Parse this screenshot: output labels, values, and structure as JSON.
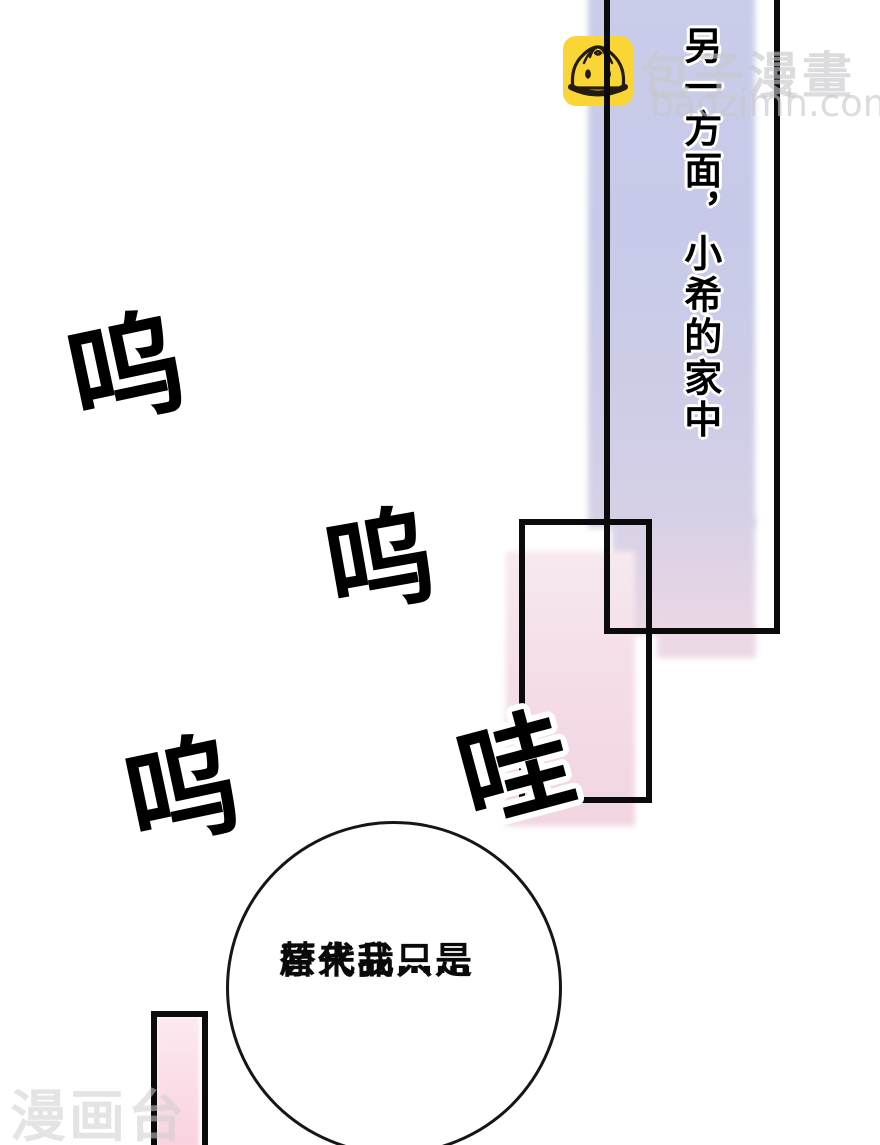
{
  "narration": {
    "text": "另一方面，小希的家中"
  },
  "sfx": [
    {
      "text": "呜"
    },
    {
      "text": "呜"
    },
    {
      "text": "呜"
    },
    {
      "text": "哇"
    }
  ],
  "bubble": {
    "line1": "原来我只是",
    "line2": "替代品……"
  },
  "watermark": {
    "site_name": "包子漫畫",
    "site_url": "baozimh.com",
    "logo": "baozi-bun-logo",
    "bottom_left": "漫画台"
  },
  "colors": {
    "page_bg": "#ffffff",
    "bar_lavender": "#c8cce9",
    "bar_pink": "#f3d9e4",
    "bar_pink_strong": "#f9d3df",
    "panel_border": "#0b0b0b",
    "logo_yellow": "#f9d536",
    "logo_line": "#241c10",
    "watermark_gray": "#c6c6ca"
  }
}
